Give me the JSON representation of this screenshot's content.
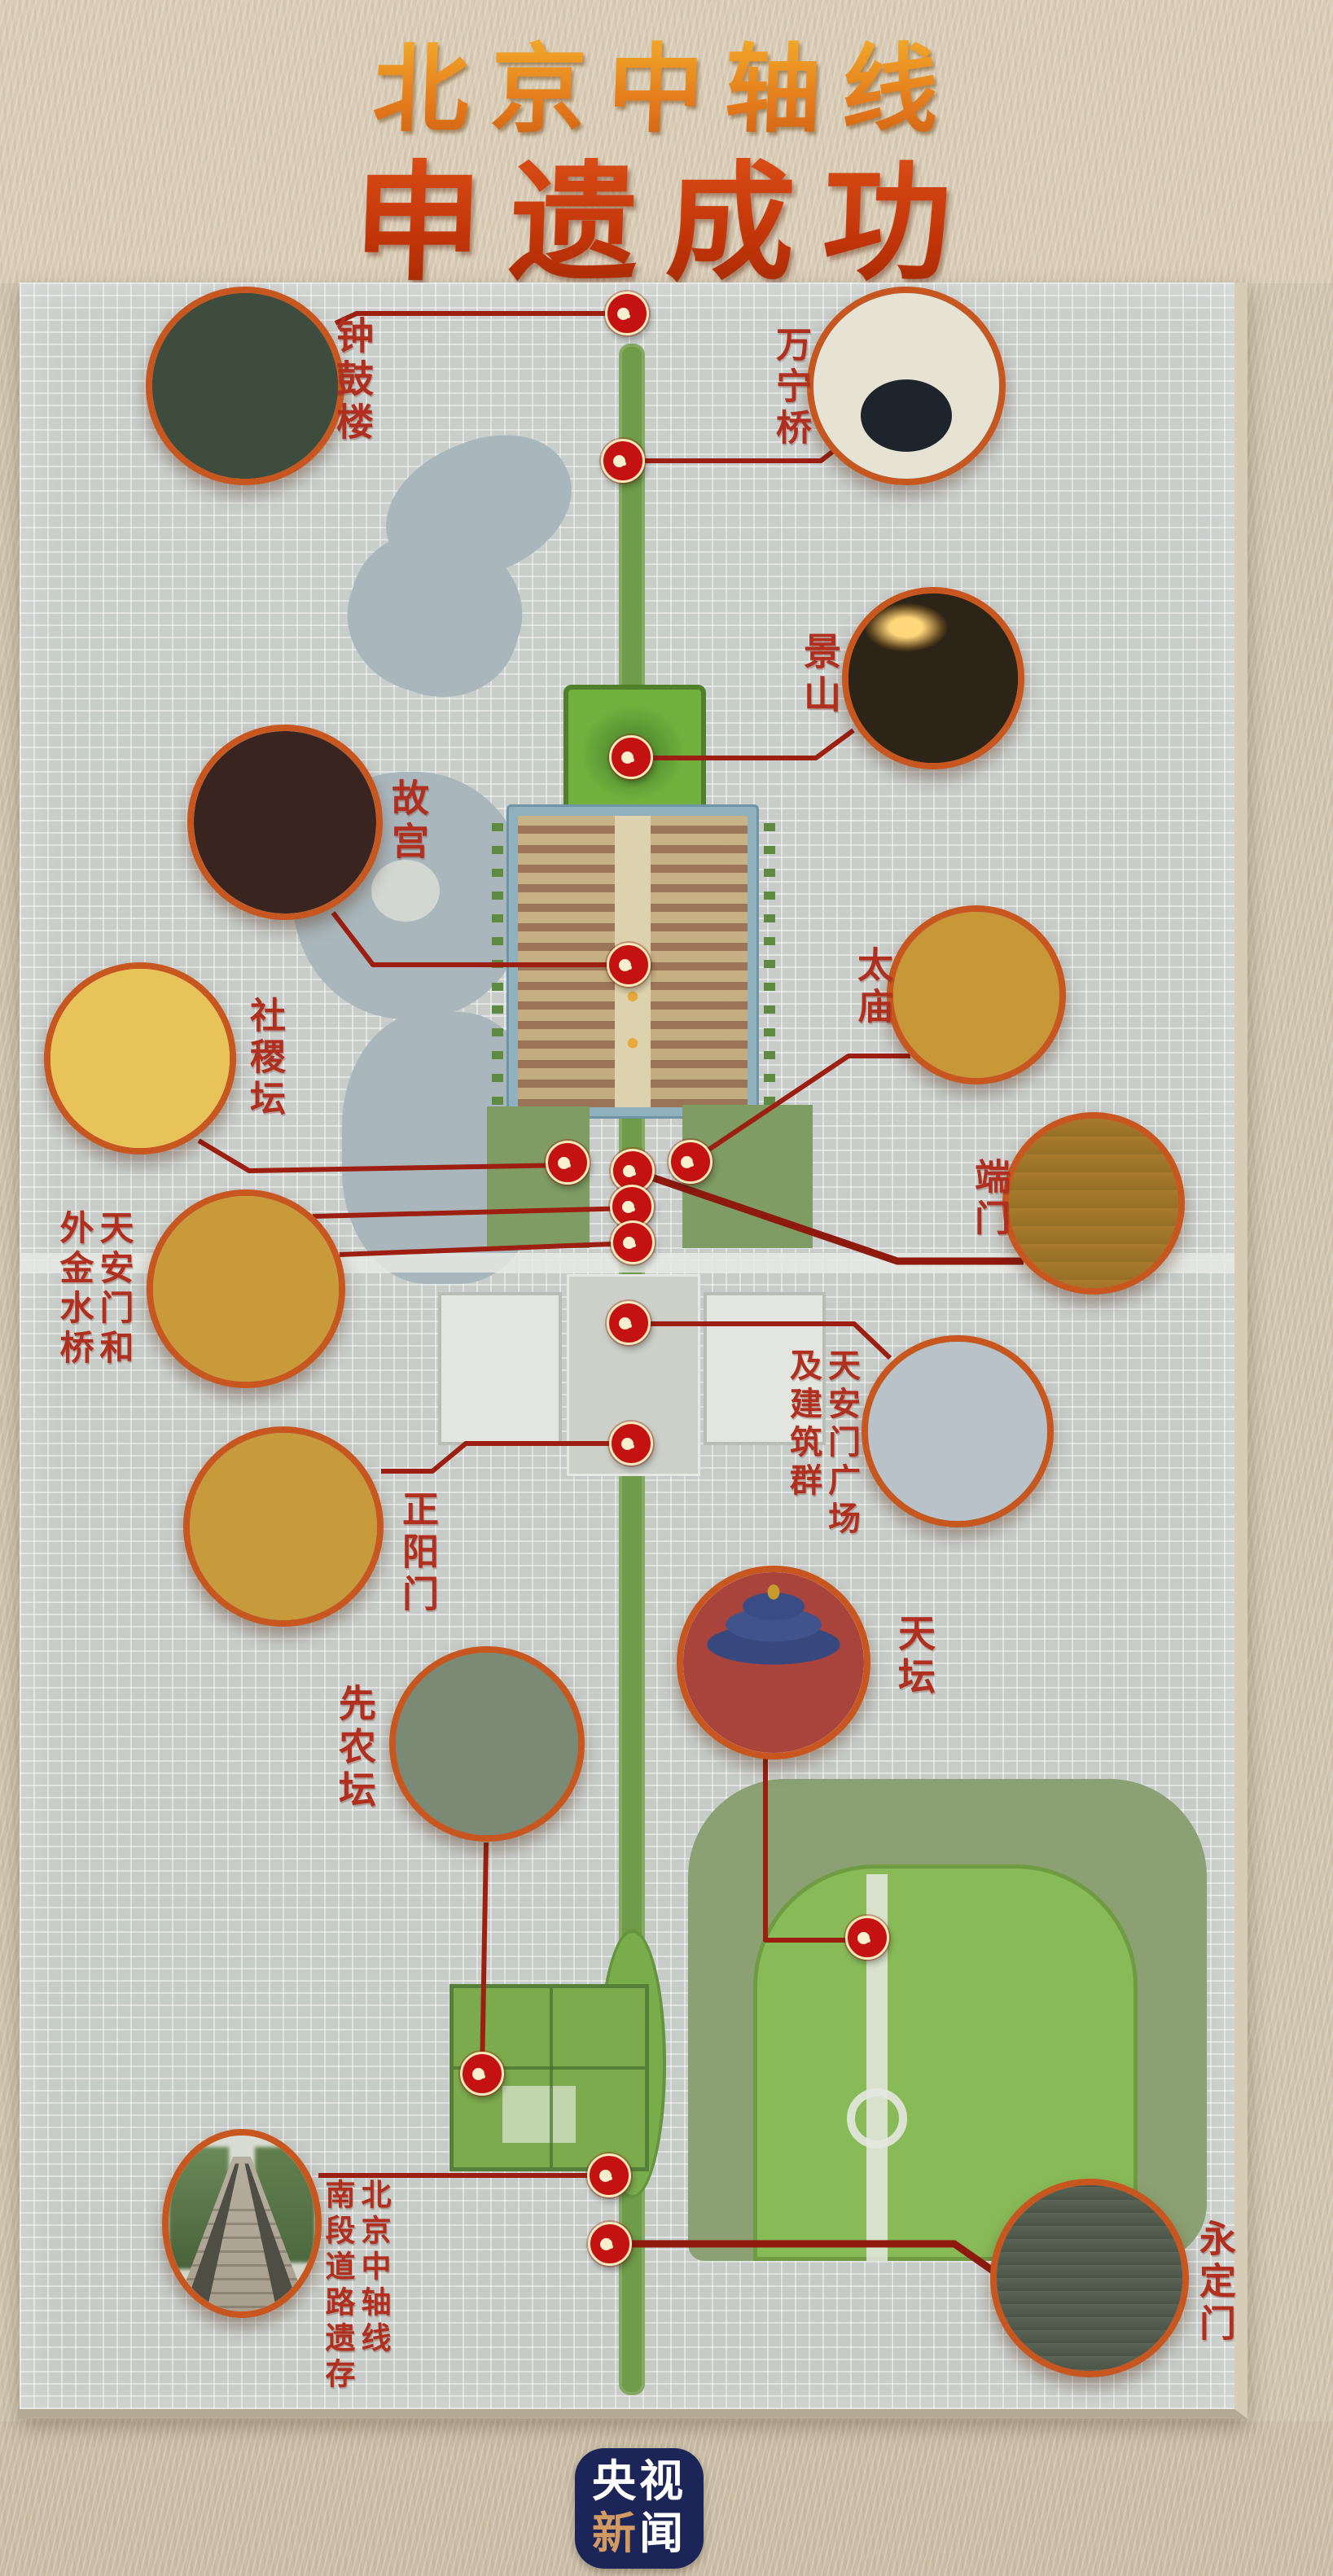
{
  "title": {
    "line1": "北京中轴线",
    "line2": "申遗成功"
  },
  "sites": [
    {
      "id": "zhonggulou",
      "label_columns": [
        "钟鼓楼"
      ]
    },
    {
      "id": "wanningqiao",
      "label_columns": [
        "万宁桥"
      ]
    },
    {
      "id": "jingshan",
      "label_columns": [
        "景山"
      ]
    },
    {
      "id": "gugong",
      "label_columns": [
        "故宫"
      ]
    },
    {
      "id": "taimiao",
      "label_columns": [
        "太庙"
      ]
    },
    {
      "id": "shejitan",
      "label_columns": [
        "社稷坛"
      ]
    },
    {
      "id": "duanmen",
      "label_columns": [
        "端门"
      ]
    },
    {
      "id": "tiananmen-waijinshuiqiao",
      "label_columns": [
        "天安门和",
        "外金水桥"
      ]
    },
    {
      "id": "tiananmen-guangchang",
      "label_columns": [
        "天安门广场",
        "及建筑群"
      ]
    },
    {
      "id": "zhengyangmen",
      "label_columns": [
        "正阳门"
      ]
    },
    {
      "id": "tiantan",
      "label_columns": [
        "天坛"
      ]
    },
    {
      "id": "xiannongtan",
      "label_columns": [
        "先农坛"
      ]
    },
    {
      "id": "nanduan-daolu-yicun",
      "label_columns": [
        "北京中轴线",
        "南段道路遗存"
      ]
    },
    {
      "id": "yongdingmen",
      "label_columns": [
        "永定门"
      ]
    }
  ],
  "logo": {
    "line1": "央视",
    "line2_first": "新",
    "line2_second": "闻"
  },
  "colors": {
    "title_gold": "#ef9c1f",
    "title_red": "#cf3a10",
    "label_red": "#b02f1e",
    "marker_red": "#c41212",
    "circle_border": "#c8561f",
    "connector": "#9c1f12",
    "logo_navy": "#1b2558",
    "logo_tan": "#d29a62",
    "map_gray": "#c9cecb",
    "park_green": "#7cab4d",
    "lake_blue": "#a9b7bd",
    "paper_beige": "#d3c7b1"
  }
}
